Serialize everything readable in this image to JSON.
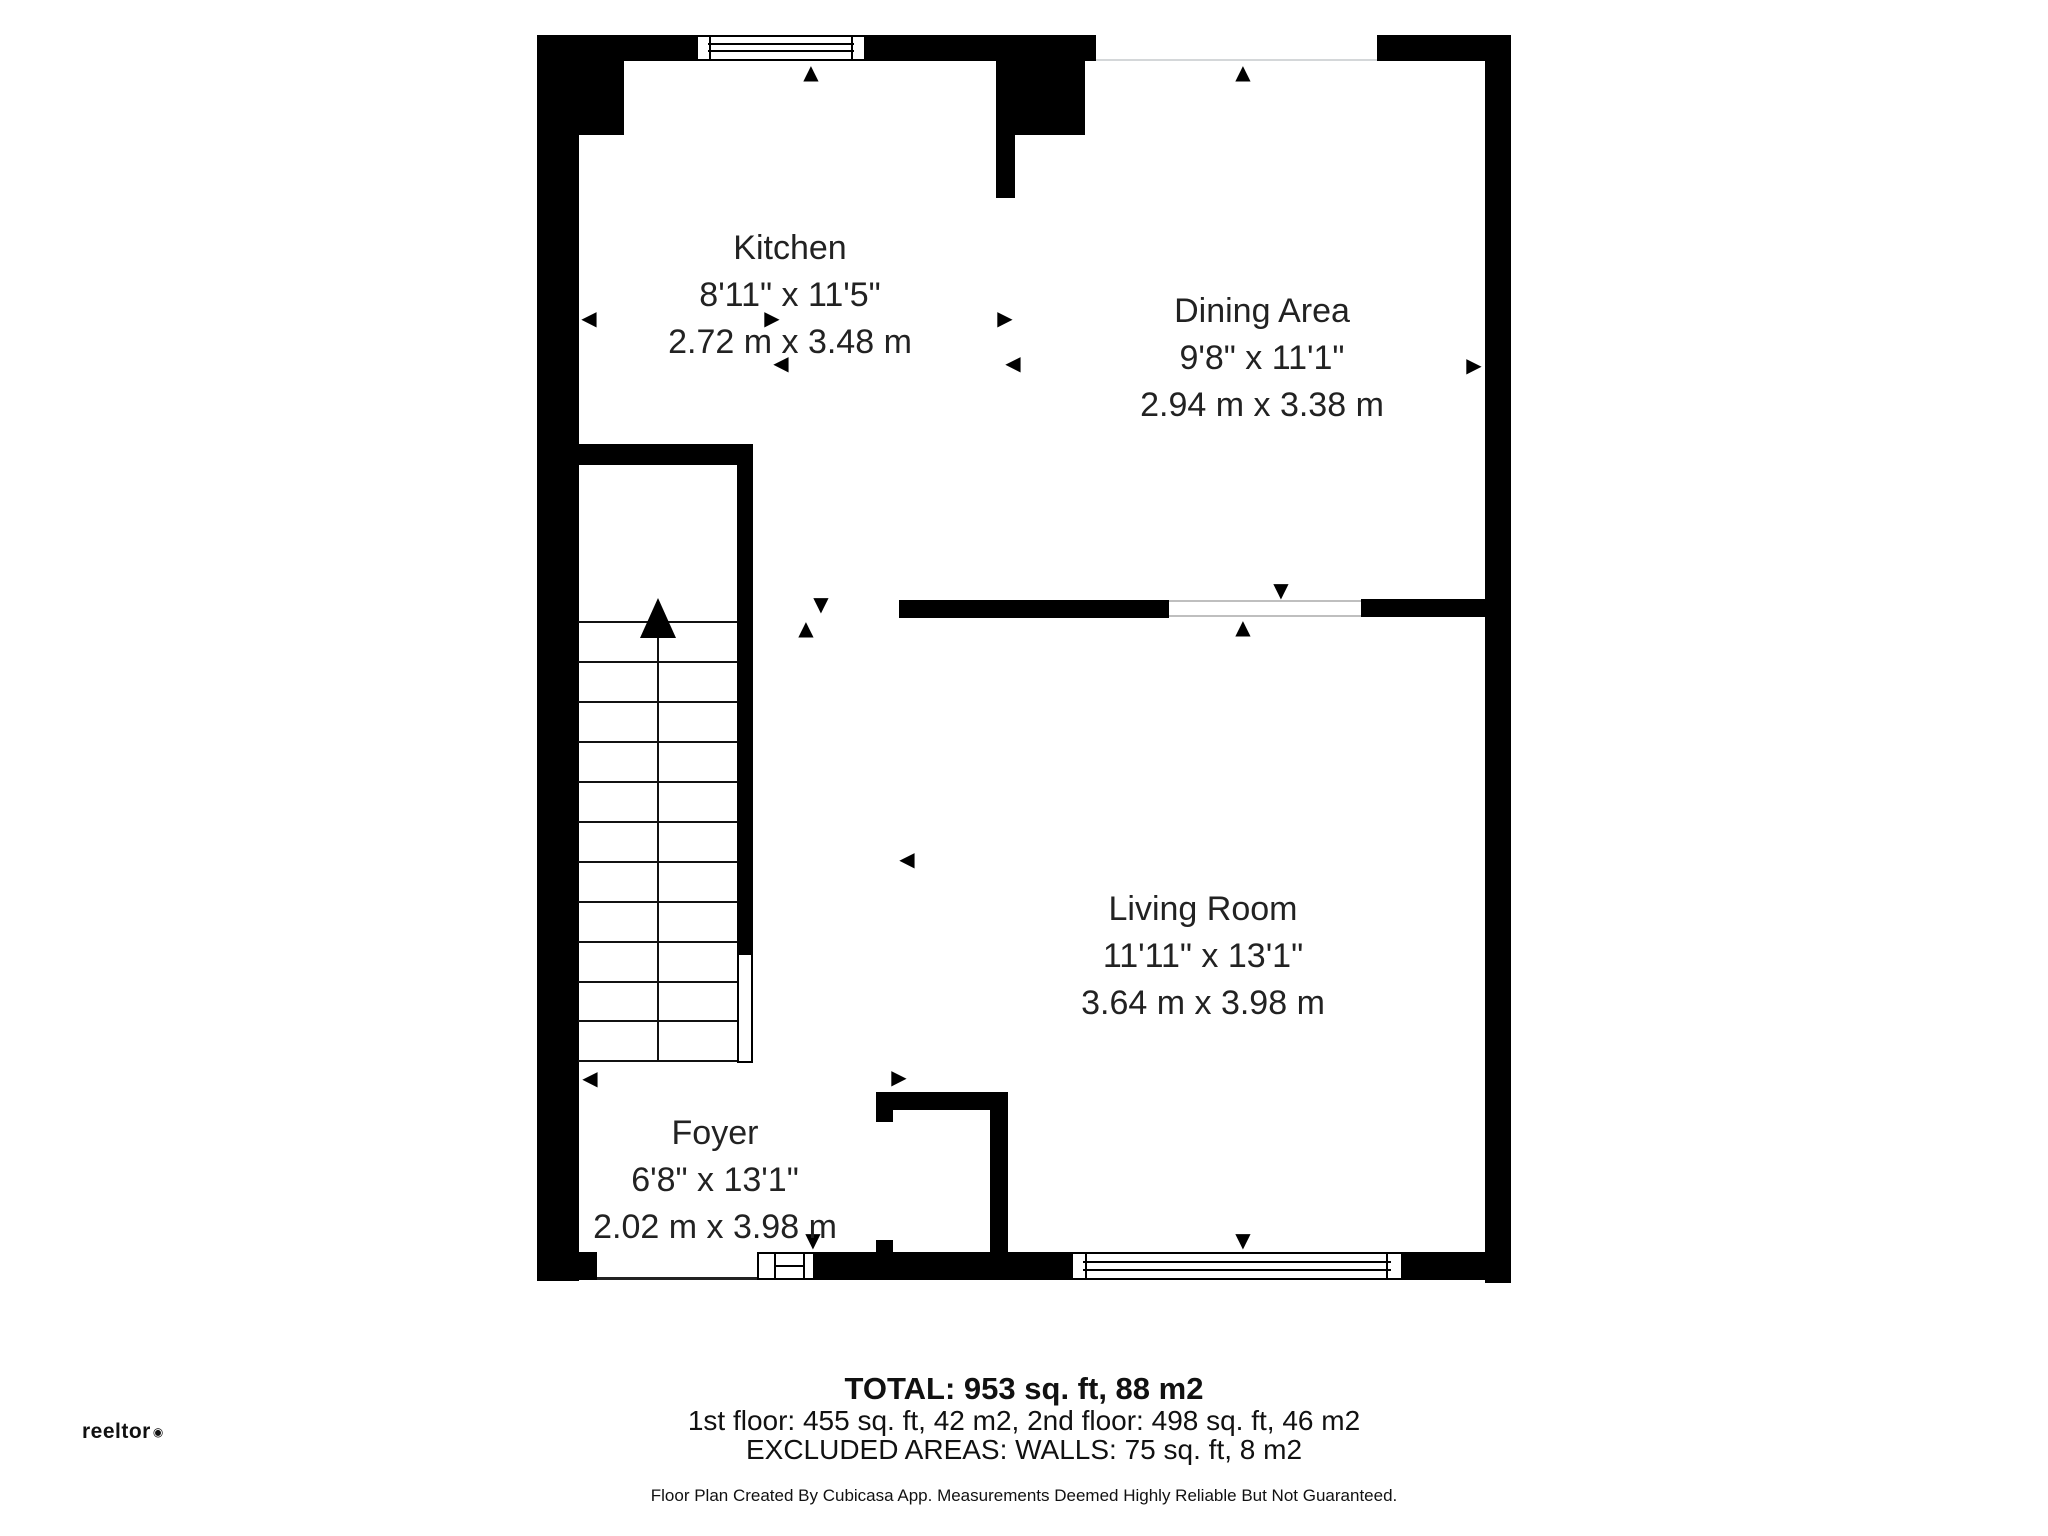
{
  "floorplan": {
    "rooms": [
      {
        "name": "Kitchen",
        "imperial": "8'11\" x 11'5\"",
        "metric": "2.72 m x 3.48 m"
      },
      {
        "name": "Dining Area",
        "imperial": "9'8\" x 11'1\"",
        "metric": "2.94 m x 3.38 m"
      },
      {
        "name": "Living Room",
        "imperial": "11'11\" x 13'1\"",
        "metric": "3.64 m x 3.98 m"
      },
      {
        "name": "Foyer",
        "imperial": "6'8\" x 13'1\"",
        "metric": "2.02 m x 3.98 m"
      }
    ],
    "stairs": {
      "direction": "up",
      "tread_ys": [
        622,
        662,
        702,
        742,
        782,
        822,
        862,
        902,
        942,
        982,
        1021,
        1061
      ]
    },
    "markers": [
      {
        "g": "▲",
        "x": 811,
        "y": 72
      },
      {
        "g": "▲",
        "x": 1243,
        "y": 72
      },
      {
        "g": "◀",
        "x": 589,
        "y": 318
      },
      {
        "g": "▶",
        "x": 772,
        "y": 318
      },
      {
        "g": "◀",
        "x": 781,
        "y": 363
      },
      {
        "g": "▶",
        "x": 1005,
        "y": 318
      },
      {
        "g": "◀",
        "x": 1013,
        "y": 363
      },
      {
        "g": "▶",
        "x": 1474,
        "y": 365
      },
      {
        "g": "▼",
        "x": 821,
        "y": 604
      },
      {
        "g": "▲",
        "x": 806,
        "y": 628
      },
      {
        "g": "▼",
        "x": 1281,
        "y": 590
      },
      {
        "g": "▲",
        "x": 1243,
        "y": 627
      },
      {
        "g": "◀",
        "x": 907,
        "y": 859
      },
      {
        "g": "▶",
        "x": 899,
        "y": 1077
      },
      {
        "g": "◀",
        "x": 590,
        "y": 1078
      },
      {
        "g": "▼",
        "x": 813,
        "y": 1240
      },
      {
        "g": "▼",
        "x": 1243,
        "y": 1240
      }
    ]
  },
  "footer": {
    "total": "TOTAL: 953 sq. ft, 88 m2",
    "floors": "1st floor: 455 sq. ft, 42 m2, 2nd floor: 498 sq. ft, 46 m2",
    "excluded": "EXCLUDED AREAS: WALLS: 75 sq. ft, 8 m2",
    "disclaimer": "Floor Plan Created By Cubicasa App. Measurements Deemed Highly Reliable But Not Guaranteed."
  },
  "branding": {
    "logo_text": "reeltor",
    "logo_mark": "◉"
  },
  "colors": {
    "wall": "#000000",
    "text": "#222222",
    "background": "#ffffff"
  }
}
